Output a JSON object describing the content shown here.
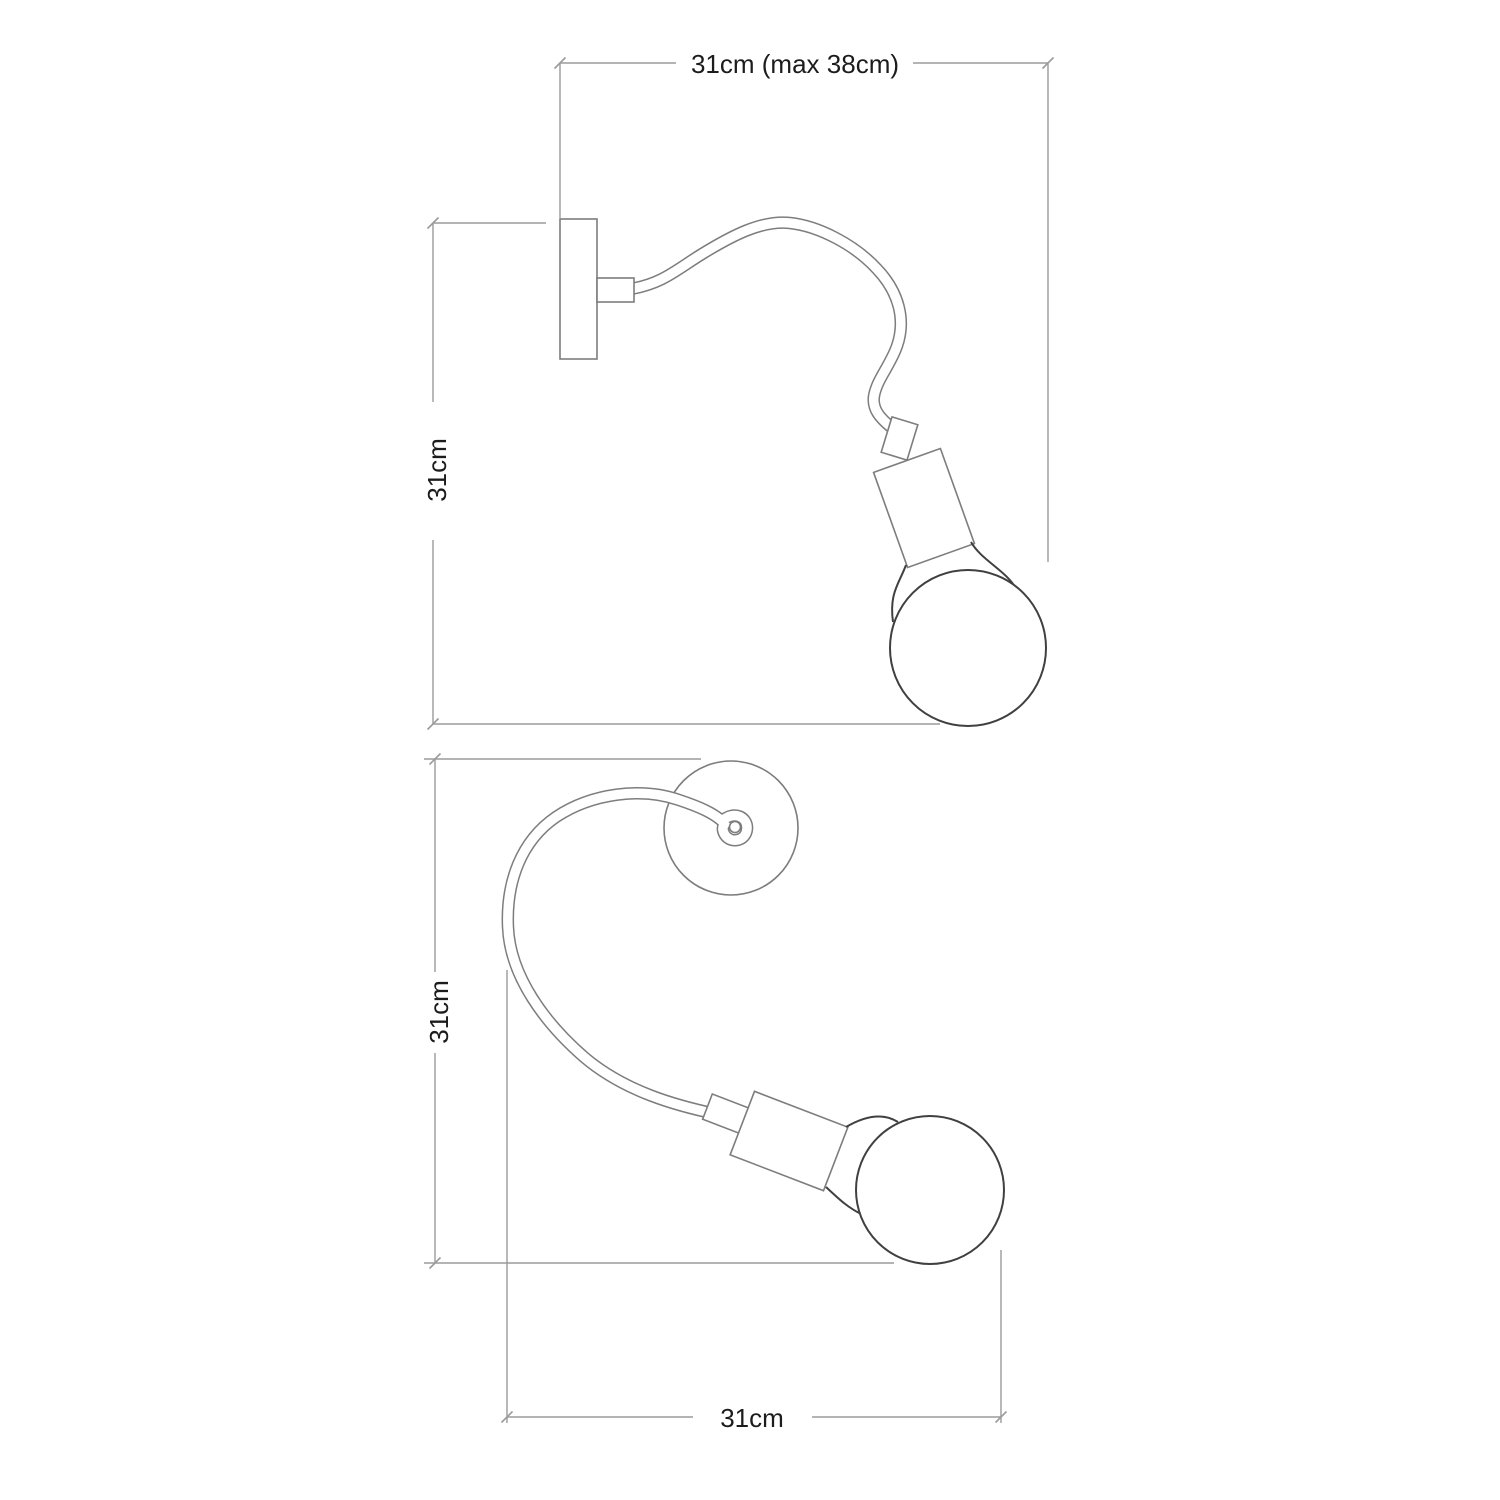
{
  "figure": {
    "type": "technical-dimension-drawing",
    "subject": "Flexible gooseneck wall lamp with exposed bulb, shown in two poses with overall dimensions"
  },
  "colors": {
    "background": "#ffffff",
    "dimension_lines": "#9b9b9b",
    "body_lines": "#7d7d7d",
    "bulb_lines": "#404040",
    "text": "#1c1c1c"
  },
  "views": {
    "side_view": {
      "width_label": "31cm (max 38cm)",
      "height_label": "31cm"
    },
    "top_view": {
      "height_label": "31cm",
      "width_label": "31cm"
    }
  }
}
